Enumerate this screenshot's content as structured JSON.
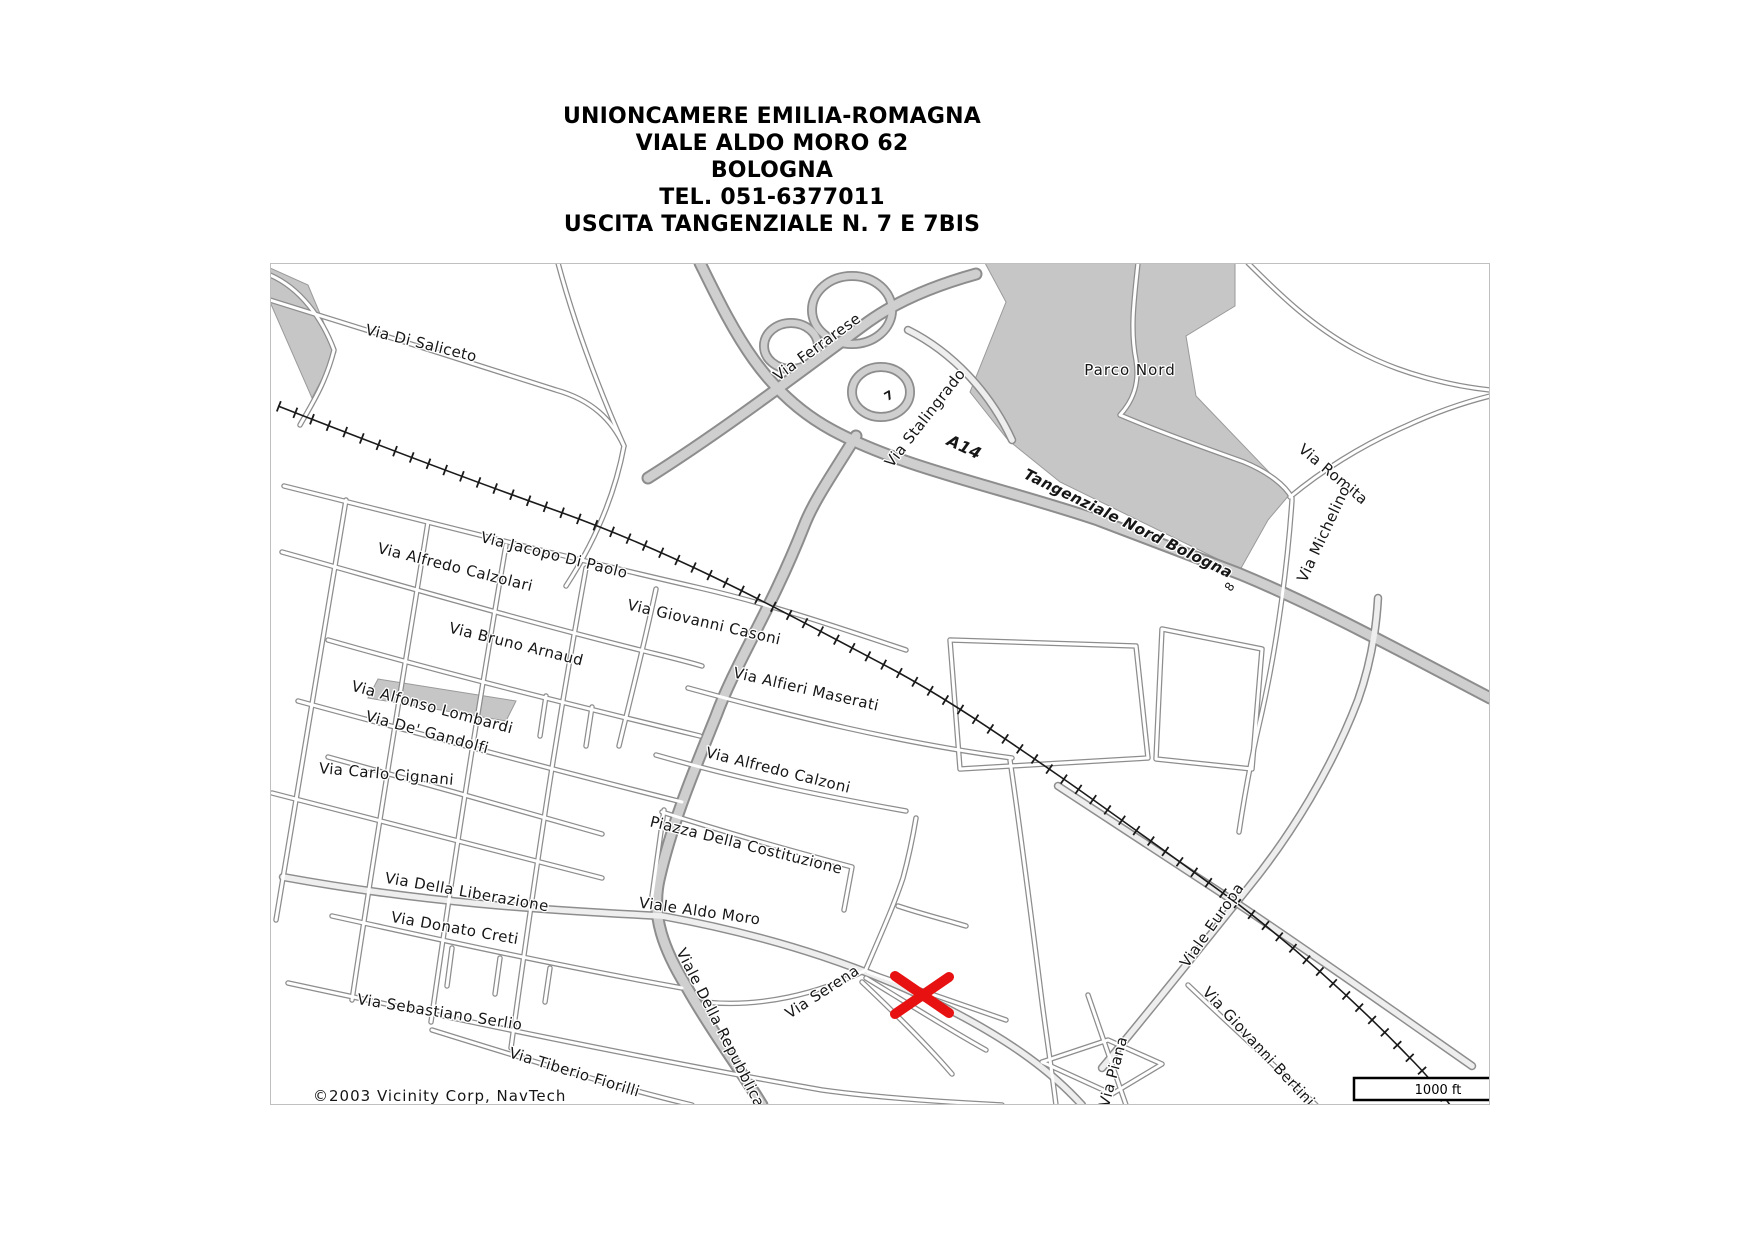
{
  "header": {
    "lines": [
      "UNIONCAMERE EMILIA-ROMAGNA",
      "VIALE ALDO MORO 62",
      "BOLOGNA",
      "TEL. 051-6377011",
      "USCITA TANGENZIALE N. 7 E 7BIS"
    ]
  },
  "map": {
    "colors": {
      "road_casing": "#8d8d8d",
      "road_fill_minor": "#ffffff",
      "road_fill_major": "#cfcfcf",
      "park_fill": "#c6c6c6",
      "railway": "#1a1a1a",
      "marker": "#e81111",
      "label": "#161616",
      "border": "#c0c0c0"
    },
    "copyright": "©2003 Vicinity Corp, NavTech",
    "scale_bar": {
      "label": "1000 ft"
    },
    "marker": {
      "name": "destination-x-marker",
      "x": 922,
      "y": 995,
      "arm": 27
    },
    "labels": [
      {
        "t": "Via Di Saliceto",
        "x": 420,
        "y": 348,
        "r": 14
      },
      {
        "t": "Via Ferrarese",
        "x": 820,
        "y": 351,
        "r": -36
      },
      {
        "t": "Via Stalingrado",
        "x": 929,
        "y": 421,
        "r": -52
      },
      {
        "t": "A14",
        "x": 962,
        "y": 452,
        "r": 25,
        "b": 1,
        "i": 1,
        "s": 16
      },
      {
        "t": "Parco Nord",
        "x": 1130,
        "y": 375,
        "r": 0,
        "ls": 1
      },
      {
        "t": "Via Romita",
        "x": 1330,
        "y": 478,
        "r": 40
      },
      {
        "t": "Via Michelino",
        "x": 1328,
        "y": 536,
        "r": -65
      },
      {
        "t": "Tangenziale Nord Bologna",
        "x": 1126,
        "y": 528,
        "r": 26,
        "b": 1,
        "i": 1
      },
      {
        "t": "7",
        "x": 891,
        "y": 399,
        "r": -30,
        "s": 12,
        "b": 1
      },
      {
        "t": "8",
        "x": 1233,
        "y": 589,
        "r": -55,
        "s": 12
      },
      {
        "t": "Via Jacopo Di Paolo",
        "x": 553,
        "y": 560,
        "r": 14
      },
      {
        "t": "Via Alfredo Calzolari",
        "x": 454,
        "y": 572,
        "r": 14
      },
      {
        "t": "Via Giovanni Casoni",
        "x": 703,
        "y": 627,
        "r": 13
      },
      {
        "t": "Via Bruno Arnaud",
        "x": 515,
        "y": 649,
        "r": 14
      },
      {
        "t": "Via Alfonso Lombardi",
        "x": 431,
        "y": 712,
        "r": 15
      },
      {
        "t": "Via De' Gandolfi",
        "x": 426,
        "y": 737,
        "r": 15
      },
      {
        "t": "Via Alfieri Maserati",
        "x": 805,
        "y": 694,
        "r": 13
      },
      {
        "t": "Via Carlo Cignani",
        "x": 386,
        "y": 779,
        "r": 5
      },
      {
        "t": "Via Alfredo Calzoni",
        "x": 777,
        "y": 775,
        "r": 14
      },
      {
        "t": "Piazza Della Costituzione",
        "x": 745,
        "y": 850,
        "r": 14
      },
      {
        "t": "Via Della Liberazione",
        "x": 466,
        "y": 897,
        "r": 10
      },
      {
        "t": "Viale Aldo Moro",
        "x": 699,
        "y": 916,
        "r": 8
      },
      {
        "t": "Via Donato Creti",
        "x": 454,
        "y": 933,
        "r": 10
      },
      {
        "t": "Via Sebastiano Serlio",
        "x": 439,
        "y": 1017,
        "r": 9
      },
      {
        "t": "Via Tiberio Fiorilli",
        "x": 573,
        "y": 1077,
        "r": 17
      },
      {
        "t": "Viale Della Repubblica",
        "x": 716,
        "y": 1030,
        "r": 63
      },
      {
        "t": "Via Serena",
        "x": 825,
        "y": 996,
        "r": -33
      },
      {
        "t": "Viale Europa",
        "x": 1216,
        "y": 928,
        "r": -55
      },
      {
        "t": "Via Piana",
        "x": 1118,
        "y": 1073,
        "r": -75
      },
      {
        "t": "Via Giovanni Bertini",
        "x": 1255,
        "y": 1050,
        "r": 47
      },
      {
        "t": "©2003 Vicinity Corp, NavTech",
        "x": 313,
        "y": 1101,
        "r": 0,
        "anchor": "start",
        "ls": 1
      }
    ],
    "areas": [
      {
        "n": "parco-nord-area",
        "d": "M985,263 L1235,263 L1235,306 L1186,336 L1196,396 L1290,494 L1268,520 L1240,570 L1060,482 L1008,440 L970,392 L1006,302 Z"
      },
      {
        "n": "grey-wedge-topleft",
        "d": "M270,268 L308,285 L336,352 L312,398 L270,302 Z"
      },
      {
        "n": "grey-strip-lombardi",
        "d": "M378,679 L516,701 L506,721 L368,698 Z"
      }
    ],
    "railways": [
      {
        "n": "railway-line",
        "d": "M278,406 C370,442 470,480 560,512 C680,555 780,610 890,668 C950,700 1010,742 1068,782 C1125,822 1180,862 1238,904 C1298,950 1356,1002 1408,1056 C1424,1072 1438,1088 1450,1105"
      }
    ],
    "roads": [
      {
        "n": "a14-tangenziale-nord",
        "c": "hw",
        "d": "M700,263 C733,330 762,392 832,430 C902,468 1000,487 1098,520 L1240,574 C1322,608 1402,652 1490,698"
      },
      {
        "n": "via-stalingrado-repubblica",
        "c": "hw",
        "d": "M856,436 C834,472 814,500 804,526 C770,612 736,662 716,716 C696,766 672,822 659,880 C651,916 664,950 686,986 C712,1032 742,1072 762,1105"
      },
      {
        "n": "via-ferrarese",
        "c": "hw",
        "d": "M648,478 C724,430 800,372 868,322 C900,299 940,284 976,274"
      },
      {
        "n": "interchange-loop-1",
        "c": "lp",
        "d": "M812,310 a40,34 0 1,0 80,0 a40,34 0 1,0 -80,0"
      },
      {
        "n": "interchange-loop-2",
        "c": "lp",
        "d": "M764,346 a27,23 0 1,0 54,0 a27,23 0 1,0 -54,0"
      },
      {
        "n": "interchange-loop-3",
        "c": "lp",
        "d": "M852,392 a29,25 0 1,0 58,0 a29,25 0 1,0 -58,0"
      },
      {
        "n": "interchange-ramp",
        "c": "av",
        "d": "M908,330 C952,352 990,392 1012,440"
      },
      {
        "n": "avenue-along-railway",
        "c": "av",
        "d": "M1058,786 C1120,826 1180,866 1238,904 C1310,952 1392,1010 1472,1066"
      },
      {
        "n": "viale-aldo-moro",
        "c": "av",
        "d": "M283,877 C420,902 540,910 662,916 C782,938 872,970 950,1010 C1012,1042 1052,1072 1082,1105"
      },
      {
        "n": "viale-europa",
        "c": "av",
        "d": "M1102,1068 C1152,1008 1200,948 1248,888 C1292,834 1332,768 1358,700 C1370,666 1376,634 1378,598"
      },
      {
        "n": "via-di-saliceto",
        "c": "mn",
        "d": "M270,300 C340,322 470,362 556,390 C592,400 612,420 624,446"
      },
      {
        "n": "north-connector",
        "c": "mn",
        "d": "M558,263 C576,330 602,396 624,446 C614,500 592,546 566,586"
      },
      {
        "n": "edge-road-topleft",
        "c": "mn",
        "d": "M270,275 C300,288 322,318 334,350 C326,382 312,404 300,425"
      },
      {
        "n": "via-jacopo-di-paolo-casoni",
        "c": "mn",
        "d": "M284,486 C420,520 560,556 700,588 C770,604 840,628 906,650"
      },
      {
        "n": "via-alfredo-calzolari",
        "c": "mn",
        "d": "M282,552 C400,585 520,620 640,650 C660,655 682,660 702,666"
      },
      {
        "n": "via-bruno-arnaud",
        "c": "mn",
        "d": "M328,640 C440,672 560,702 700,736"
      },
      {
        "n": "via-alfonso-lombardi",
        "c": "mn",
        "d": "M298,701 C420,734 550,769 682,802"
      },
      {
        "n": "via-de-gandolfi",
        "c": "mn",
        "d": "M328,757 C420,782 510,808 602,834"
      },
      {
        "n": "via-carlo-cignani",
        "c": "mn",
        "d": "M272,793 C380,820 490,850 602,878"
      },
      {
        "n": "via-donato-creti",
        "c": "mn",
        "d": "M332,916 C450,942 560,966 682,988"
      },
      {
        "n": "via-sebastiano-serlio",
        "c": "mn",
        "d": "M288,983 C460,1020 640,1058 822,1090 C880,1098 942,1102 1002,1105"
      },
      {
        "n": "via-tiberio-fiorilli",
        "c": "mn",
        "d": "M432,1030 C522,1058 612,1086 692,1105"
      },
      {
        "n": "cross-street-1",
        "c": "mn",
        "d": "M346,500 C322,640 300,780 276,920"
      },
      {
        "n": "cross-street-2",
        "c": "mn",
        "d": "M428,522 C406,660 382,800 352,1000"
      },
      {
        "n": "cross-street-3",
        "c": "mn",
        "d": "M506,545 C483,680 460,820 431,1022"
      },
      {
        "n": "cross-street-4",
        "c": "mn",
        "d": "M586,568 C562,700 541,830 511,1048"
      },
      {
        "n": "cross-street-5",
        "c": "mn",
        "d": "M656,589 C643,650 630,700 619,746"
      },
      {
        "n": "stub-a",
        "c": "mn",
        "d": "M546,696 L540,736"
      },
      {
        "n": "stub-b",
        "c": "mn",
        "d": "M592,707 L586,746"
      },
      {
        "n": "stub-c",
        "c": "mn",
        "d": "M452,948 L447,986"
      },
      {
        "n": "stub-d",
        "c": "mn",
        "d": "M500,958 L495,994"
      },
      {
        "n": "stub-e",
        "c": "mn",
        "d": "M550,968 L545,1002"
      },
      {
        "n": "costituzione-block-top",
        "c": "mn",
        "d": "M662,812 C730,834 792,851 852,867 L844,910"
      },
      {
        "n": "costituzione-block-left",
        "c": "mn",
        "d": "M664,810 L652,896"
      },
      {
        "n": "via-alfieri-maserati",
        "c": "mn",
        "d": "M688,688 C790,716 900,743 1012,758"
      },
      {
        "n": "via-alfredo-calzoni",
        "c": "mn",
        "d": "M656,755 C740,779 822,796 906,811"
      },
      {
        "n": "east-block-a",
        "c": "mn",
        "d": "M950,640 L1136,646 L1148,758 L960,769 L950,640"
      },
      {
        "n": "east-block-b",
        "c": "mn",
        "d": "M1162,629 L1262,649 L1252,769 L1156,759 L1162,629"
      },
      {
        "n": "east-vertical-road",
        "c": "mn",
        "d": "M1010,760 C1022,842 1032,922 1042,1002 C1047,1040 1052,1072 1056,1105"
      },
      {
        "n": "via-michelino",
        "c": "mn",
        "d": "M1292,500 C1288,560 1278,640 1262,712 C1252,754 1245,792 1239,832"
      },
      {
        "n": "via-romita",
        "c": "mn",
        "d": "M1290,497 C1320,472 1360,446 1406,426 C1436,412 1466,402 1490,396"
      },
      {
        "n": "ne-corner-road",
        "c": "mn",
        "d": "M1248,263 C1280,295 1312,326 1356,350 C1400,374 1452,386 1490,390"
      },
      {
        "n": "parco-nord-path",
        "c": "mn",
        "d": "M1138,263 C1134,300 1130,330 1136,360 C1140,385 1132,402 1120,415 C1160,432 1205,448 1244,462 C1268,472 1285,485 1292,498"
      },
      {
        "n": "via-piana",
        "c": "mn",
        "d": "M1088,995 C1100,1030 1112,1064 1126,1105"
      },
      {
        "n": "via-giovanni-bertini",
        "c": "mn",
        "d": "M1188,985 C1230,1025 1272,1063 1316,1105"
      },
      {
        "n": "bottom-diamond-block",
        "c": "mn",
        "d": "M1042,1062 L1108,1040 L1162,1064 L1112,1094 L1042,1062"
      },
      {
        "n": "via-serena",
        "c": "mn",
        "d": "M704,1002 C760,1008 818,994 866,970"
      },
      {
        "n": "serena-north-spur",
        "c": "mn",
        "d": "M866,969 C880,936 893,908 903,878 C909,856 913,836 916,818"
      },
      {
        "n": "serena-fan-1",
        "c": "mn",
        "d": "M868,972 C920,990 966,1006 1006,1020"
      },
      {
        "n": "serena-fan-2",
        "c": "mn",
        "d": "M866,978 C912,1006 950,1030 986,1050"
      },
      {
        "n": "serena-fan-3",
        "c": "mn",
        "d": "M862,982 C898,1016 928,1046 952,1074"
      },
      {
        "n": "aldo-moro-spur",
        "c": "mn",
        "d": "M898,906 C922,914 946,920 966,926"
      }
    ]
  }
}
